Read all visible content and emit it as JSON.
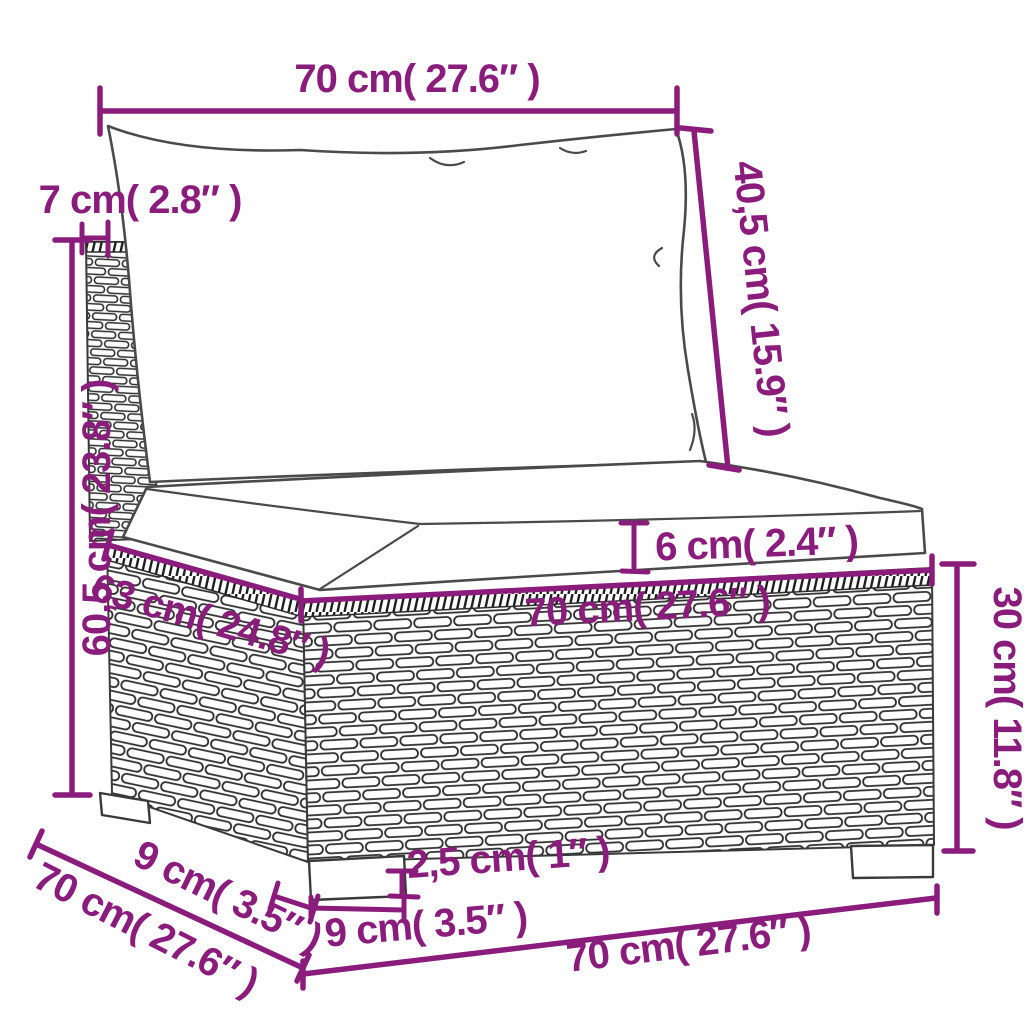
{
  "diagram": {
    "subject": "poly-rattan-garden-sofa-middle-section-dimension-drawing",
    "colors": {
      "dimension_annotation": "#8A1C7C",
      "artwork_outline": "#3A3A3A",
      "background": "#FFFFFF"
    },
    "labels": {
      "top_width": "70 cm( 27.6″ )",
      "back_cushion_height": "40,5 cm( 15.9″ )",
      "back_panel_thickness": "7 cm( 2.8″ )",
      "total_height": "60,5 cm( 23.8″ )",
      "seat_cushion_thickness": "6 cm( 2.4″ )",
      "seat_width": "70 cm( 27.6″ )",
      "seat_depth": "63 cm( 24.8″ )",
      "base_height": "30 cm( 11.8″ )",
      "foot_height": "2,5 cm( 1″ )",
      "foot_width": "9 cm( 3.5″ )",
      "foot_depth": "9 cm( 3.5″ )",
      "base_depth": "70 cm( 27.6″ )",
      "base_width": "70 cm( 27.6″ )"
    }
  }
}
